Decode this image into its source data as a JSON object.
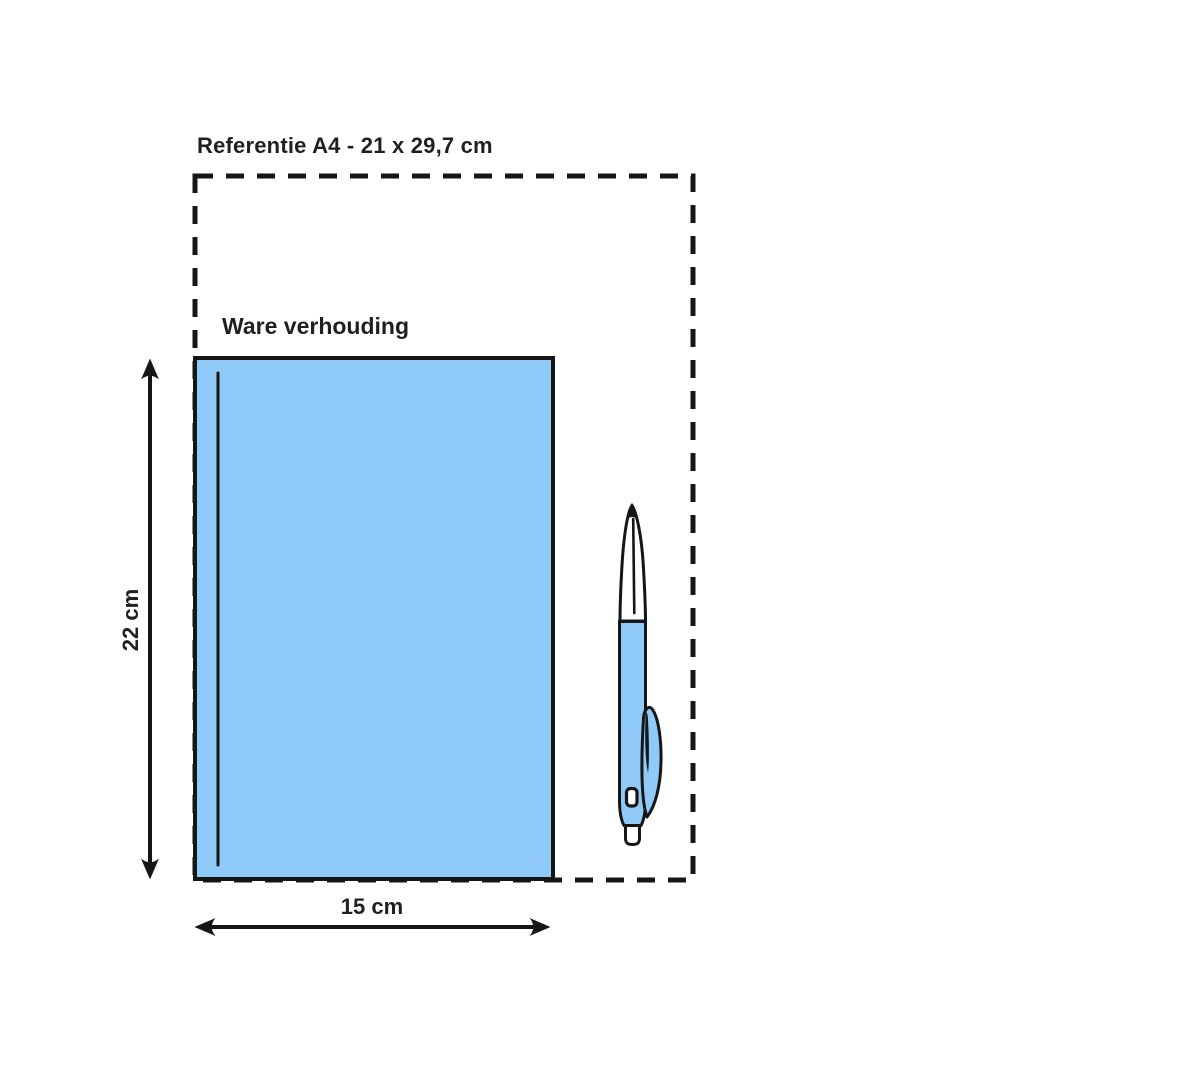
{
  "labels": {
    "reference": "Referentie A4 - 21 x 29,7 cm",
    "true_scale": "Ware verhouding",
    "height": "22 cm",
    "width": "15 cm"
  },
  "dimensions": {
    "reference_format": "A4",
    "reference_size_cm": "21 x 29,7",
    "item_height_cm": "22",
    "item_width_cm": "15"
  },
  "icons": {
    "pen": "ballpoint-pen-scale-icon",
    "a4_outline": "dashed-reference-outline",
    "height_arrow": "double-headed-vertical-arrow",
    "width_arrow": "double-headed-horizontal-arrow"
  },
  "colors": {
    "item_fill": "#8fcaf9",
    "pen_fill": "#8fcaf9",
    "outline": "#161616",
    "text": "#231f20",
    "background": "#ffffff"
  }
}
